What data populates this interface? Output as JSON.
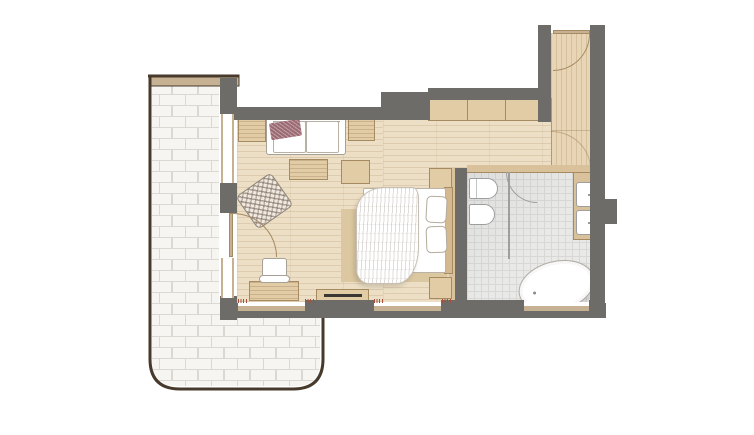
{
  "plan": {
    "type": "floor-plan",
    "title": "",
    "rooms": [
      {
        "id": "balcony-terrace",
        "floor": "white-brick-pavers"
      },
      {
        "id": "living-bedroom",
        "floor": "wood-planks-horizontal"
      },
      {
        "id": "entry-corridor",
        "floor": "wood-planks-vertical"
      },
      {
        "id": "bathroom",
        "floor": "gray-tile-grid"
      }
    ],
    "furniture": [
      "sofa",
      "throw-blanket",
      "side-table-left",
      "side-table-right",
      "coffee-table",
      "woven-armchair",
      "desk",
      "desk-chair",
      "tv-console",
      "tv",
      "bench",
      "double-bed",
      "duvet",
      "pillow",
      "pillow",
      "headboard",
      "nightstand-top",
      "nightstand-bottom",
      "rug",
      "wardrobe",
      "wall-panel"
    ],
    "fixtures": [
      "toilet",
      "bidet",
      "vanity-counter",
      "sink-upper",
      "sink-lower",
      "freestanding-bathtub",
      "shower-partition"
    ],
    "openings": [
      "entry-door-with-swing",
      "balcony-door-with-swing",
      "bathroom-door-with-swing",
      "window-left-upper",
      "window-left-lower",
      "window-bottom-left",
      "window-bottom-middle",
      "bathroom-window",
      "wall-niche"
    ],
    "annotations": {
      "dimension_marks_count": 7,
      "mark_color": "#a44f3a",
      "legible_text": ""
    },
    "colors": {
      "wall": "#6e6c69",
      "floor": "#ecdfc5",
      "corridor": "#e8d5b5",
      "tile": "#e9e9e8",
      "tileLine": "#d8d8d6",
      "tan": "#e2cca6",
      "tanBorder": "#a68a61",
      "brick": "#f6f5f2",
      "brickLine": "#dbd8d2",
      "balconyBorder": "#473a2c",
      "cap": "#c6b193",
      "rug": "#dbc7a0",
      "panel": "#d9c19b",
      "throw": "#9c6a73",
      "accent": "#a44f3a",
      "outline": "#a7a094",
      "white": "#ffffff",
      "tv": "#3a3733",
      "fixture": "#9e9e9e"
    }
  }
}
